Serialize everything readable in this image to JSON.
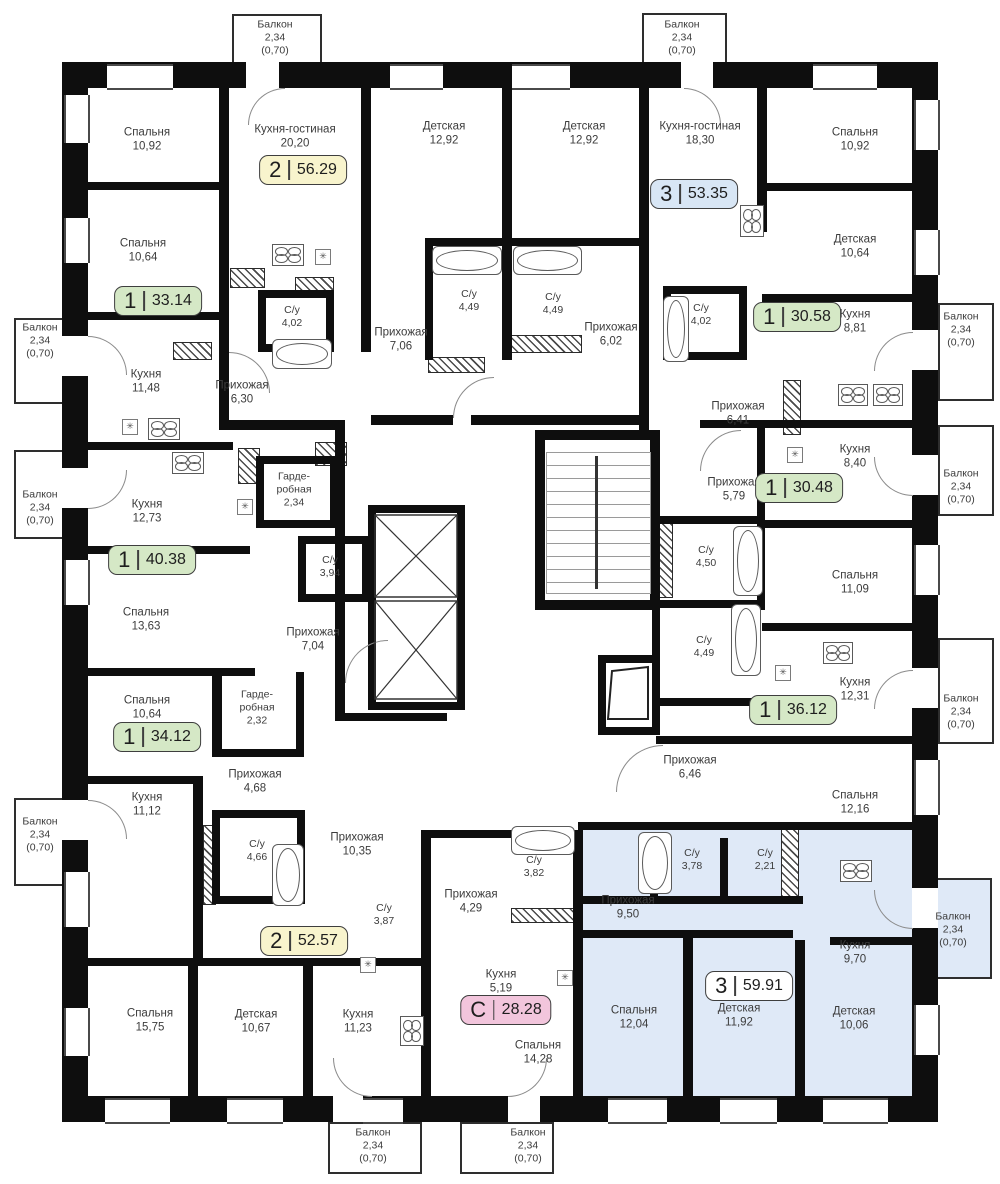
{
  "plan_title": "Floor plan",
  "legend_colors": {
    "one_room": "#d5e8c6",
    "two_room": "#f8f4cd",
    "three_room": "#d8e6f5",
    "studio": "#f2c5dc",
    "selected_fill": "#dfe9f7",
    "badge_border": "#3e3e3e"
  },
  "units": [
    {
      "rooms_label": "2",
      "area": "56.29",
      "color": "#f8f4cd",
      "x": 303,
      "y": 170
    },
    {
      "rooms_label": "3",
      "area": "53.35",
      "color": "#d8e6f5",
      "x": 694,
      "y": 194
    },
    {
      "rooms_label": "1",
      "area": "33.14",
      "color": "#d5e8c6",
      "x": 158,
      "y": 301
    },
    {
      "rooms_label": "1",
      "area": "30.58",
      "color": "#d5e8c6",
      "x": 797,
      "y": 317
    },
    {
      "rooms_label": "1",
      "area": "30.48",
      "color": "#d5e8c6",
      "x": 799,
      "y": 488
    },
    {
      "rooms_label": "1",
      "area": "40.38",
      "color": "#d5e8c6",
      "x": 152,
      "y": 560
    },
    {
      "rooms_label": "1",
      "area": "36.12",
      "color": "#d5e8c6",
      "x": 793,
      "y": 710
    },
    {
      "rooms_label": "1",
      "area": "34.12",
      "color": "#d5e8c6",
      "x": 157,
      "y": 737
    },
    {
      "rooms_label": "2",
      "area": "52.57",
      "color": "#f8f4cd",
      "x": 304,
      "y": 941
    },
    {
      "rooms_label": "С",
      "area": "28.28",
      "color": "#f2c5dc",
      "x": 506,
      "y": 1010
    },
    {
      "rooms_label": "3",
      "area": "59.91",
      "color": "#ffffff",
      "x": 749,
      "y": 986
    }
  ],
  "rooms": [
    {
      "name": "Спальня",
      "area": "10,92",
      "x": 147,
      "y": 140
    },
    {
      "name": "Кухня-гостиная",
      "area": "20,20",
      "x": 295,
      "y": 137
    },
    {
      "name": "Детская",
      "area": "12,92",
      "x": 444,
      "y": 134
    },
    {
      "name": "Детская",
      "area": "12,92",
      "x": 584,
      "y": 134
    },
    {
      "name": "Кухня-гостиная",
      "area": "18,30",
      "x": 700,
      "y": 134
    },
    {
      "name": "Спальня",
      "area": "10,92",
      "x": 855,
      "y": 140
    },
    {
      "name": "Спальня",
      "area": "10,64",
      "x": 143,
      "y": 251
    },
    {
      "name": "Детская",
      "area": "10,64",
      "x": 855,
      "y": 247
    },
    {
      "name": "С/у",
      "area": "4,02",
      "x": 292,
      "y": 317,
      "small": true
    },
    {
      "name": "С/у",
      "area": "4,49",
      "x": 469,
      "y": 301,
      "small": true
    },
    {
      "name": "С/у",
      "area": "4,49",
      "x": 553,
      "y": 304,
      "small": true
    },
    {
      "name": "Прихожая",
      "area": "7,06",
      "x": 401,
      "y": 340
    },
    {
      "name": "Прихожая",
      "area": "6,02",
      "x": 611,
      "y": 335
    },
    {
      "name": "С/у",
      "area": "4,02",
      "x": 701,
      "y": 315,
      "small": true
    },
    {
      "name": "Кухня",
      "area": "8,81",
      "x": 855,
      "y": 322
    },
    {
      "name": "Кухня",
      "area": "11,48",
      "x": 146,
      "y": 382
    },
    {
      "name": "Прихожая",
      "area": "6,30",
      "x": 242,
      "y": 393
    },
    {
      "name": "Прихожая",
      "area": "6,41",
      "x": 738,
      "y": 414
    },
    {
      "name": "Кухня",
      "area": "8,40",
      "x": 855,
      "y": 457
    },
    {
      "name": "Гарде­робная",
      "area": "2,34",
      "x": 294,
      "y": 490,
      "small": true,
      "w": 56
    },
    {
      "name": "Кухня",
      "area": "12,73",
      "x": 147,
      "y": 512
    },
    {
      "name": "Прихожая",
      "area": "5,79",
      "x": 734,
      "y": 490
    },
    {
      "name": "С/у",
      "area": "3,94",
      "x": 330,
      "y": 567,
      "small": true
    },
    {
      "name": "С/у",
      "area": "4,50",
      "x": 706,
      "y": 557,
      "small": true
    },
    {
      "name": "Спальня",
      "area": "11,09",
      "x": 855,
      "y": 583
    },
    {
      "name": "Спальня",
      "area": "13,63",
      "x": 146,
      "y": 620
    },
    {
      "name": "Прихожая",
      "area": "7,04",
      "x": 313,
      "y": 640
    },
    {
      "name": "С/у",
      "area": "4,49",
      "x": 704,
      "y": 647,
      "small": true
    },
    {
      "name": "Кухня",
      "area": "12,31",
      "x": 855,
      "y": 690
    },
    {
      "name": "Гарде­робная",
      "area": "2,32",
      "x": 257,
      "y": 708,
      "small": true,
      "w": 56
    },
    {
      "name": "Спальня",
      "area": "10,64",
      "x": 147,
      "y": 708
    },
    {
      "name": "Прихожая",
      "area": "6,46",
      "x": 690,
      "y": 768
    },
    {
      "name": "Спальня",
      "area": "12,16",
      "x": 855,
      "y": 803
    },
    {
      "name": "Прихожая",
      "area": "4,68",
      "x": 255,
      "y": 782
    },
    {
      "name": "Кухня",
      "area": "11,12",
      "x": 147,
      "y": 805
    },
    {
      "name": "С/у",
      "area": "4,66",
      "x": 257,
      "y": 851,
      "small": true
    },
    {
      "name": "Прихожая",
      "area": "10,35",
      "x": 357,
      "y": 845
    },
    {
      "name": "С/у",
      "area": "3,78",
      "x": 692,
      "y": 860,
      "small": true
    },
    {
      "name": "С/у",
      "area": "2,21",
      "x": 765,
      "y": 860,
      "small": true
    },
    {
      "name": "Прихожая",
      "area": "9,50",
      "x": 628,
      "y": 908
    },
    {
      "name": "Кухня",
      "area": "9,70",
      "x": 855,
      "y": 953
    },
    {
      "name": "С/у",
      "area": "3,87",
      "x": 384,
      "y": 915,
      "small": true
    },
    {
      "name": "С/у",
      "area": "3,82",
      "x": 534,
      "y": 867,
      "small": true
    },
    {
      "name": "Прихожая",
      "area": "4,29",
      "x": 471,
      "y": 902
    },
    {
      "name": "Кухня",
      "area": "5,19",
      "x": 501,
      "y": 982
    },
    {
      "name": "Спальня",
      "area": "14,28",
      "x": 538,
      "y": 1053
    },
    {
      "name": "Спальня",
      "area": "12,04",
      "x": 634,
      "y": 1018
    },
    {
      "name": "Детская",
      "area": "11,92",
      "x": 739,
      "y": 1016
    },
    {
      "name": "Детская",
      "area": "10,06",
      "x": 854,
      "y": 1019
    },
    {
      "name": "Спальня",
      "area": "15,75",
      "x": 150,
      "y": 1021
    },
    {
      "name": "Детская",
      "area": "10,67",
      "x": 256,
      "y": 1022
    },
    {
      "name": "Кухня",
      "area": "11,23",
      "x": 358,
      "y": 1022
    }
  ],
  "balconies": [
    {
      "name": "Балкон",
      "area": "2,34",
      "note": "(0,70)",
      "x": 275,
      "y": 38
    },
    {
      "name": "Балкон",
      "area": "2,34",
      "note": "(0,70)",
      "x": 682,
      "y": 38
    },
    {
      "name": "Балкон",
      "area": "2,34",
      "note": "(0,70)",
      "x": 40,
      "y": 341
    },
    {
      "name": "Балкон",
      "area": "2,34",
      "note": "(0,70)",
      "x": 40,
      "y": 508
    },
    {
      "name": "Балкон",
      "area": "2,34",
      "note": "(0,70)",
      "x": 40,
      "y": 835
    },
    {
      "name": "Балкон",
      "area": "2,34",
      "note": "(0,70)",
      "x": 961,
      "y": 330
    },
    {
      "name": "Балкон",
      "area": "2,34",
      "note": "(0,70)",
      "x": 961,
      "y": 487
    },
    {
      "name": "Балкон",
      "area": "2,34",
      "note": "(0,70)",
      "x": 961,
      "y": 712
    },
    {
      "name": "Балкон",
      "area": "2,34",
      "note": "(0,70)",
      "x": 953,
      "y": 930
    },
    {
      "name": "Балкон",
      "area": "2,34",
      "note": "(0,70)",
      "x": 373,
      "y": 1146
    },
    {
      "name": "Балкон",
      "area": "2,34",
      "note": "(0,70)",
      "x": 528,
      "y": 1146
    }
  ]
}
